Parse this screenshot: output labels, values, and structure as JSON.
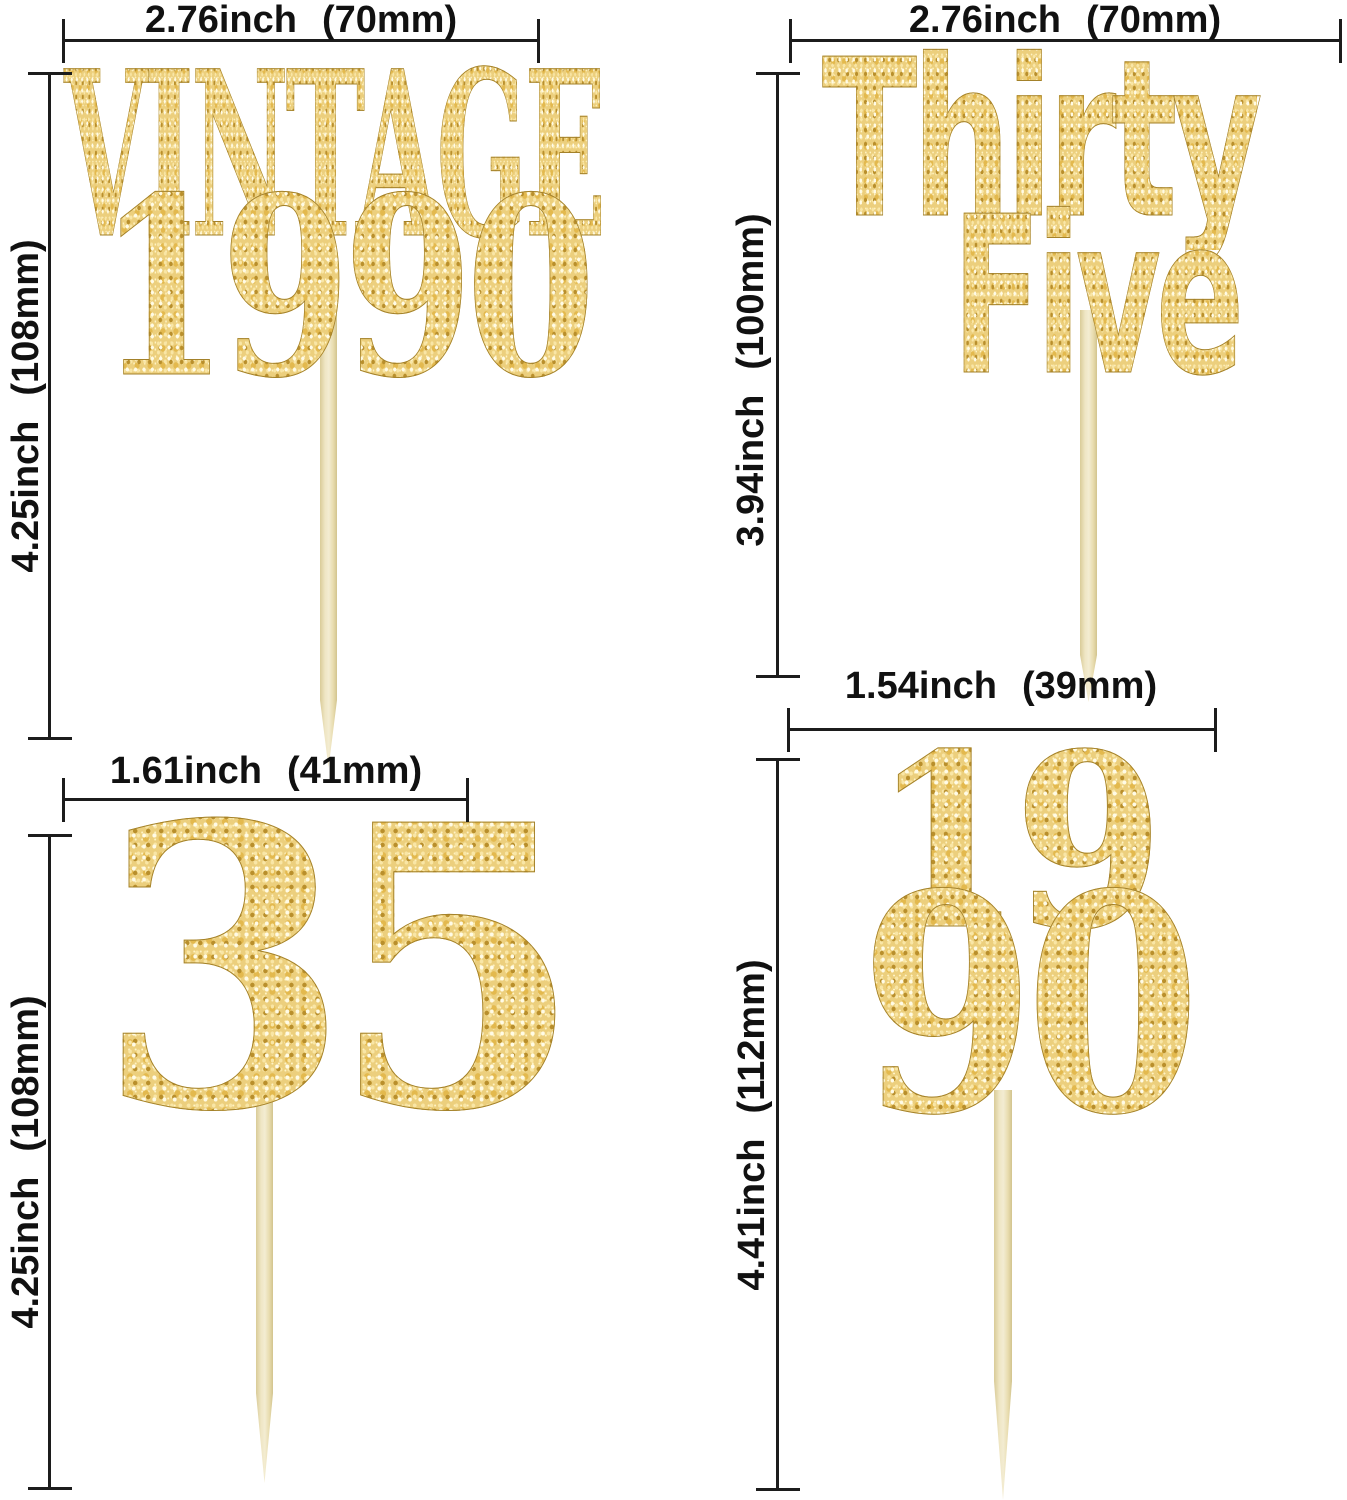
{
  "colors": {
    "background": "#ffffff",
    "dimension_line": "#1c1c1c",
    "label_text": "#111111",
    "gold_base": "#eccf7d",
    "gold_light": "#fffbe6",
    "gold_mid": "#e3b94e",
    "gold_dark": "#b98f2c",
    "gold_edge": "#a3812a",
    "stick_light": "#f3ecd2",
    "stick_dark": "#d9cb98"
  },
  "toppers": [
    {
      "id": "vintage-1990",
      "text_line1": "VINTAGE",
      "text_line2": "1990",
      "width_label": "2.76inch (70mm)",
      "height_label": "4.25inch (108mm)"
    },
    {
      "id": "thirty-five",
      "text_line1": "Thirty",
      "text_line2": "Five",
      "width_label": "2.76inch (70mm)",
      "height_label": "3.94inch (100mm)"
    },
    {
      "id": "number-35",
      "text_line1": "35",
      "width_label": "1.61inch (41mm)",
      "height_label": "4.25inch (108mm)"
    },
    {
      "id": "number-19-90",
      "text_line1": "19",
      "text_line2": "90",
      "width_label": "1.54inch (39mm)",
      "height_label": "4.41inch (112mm)"
    }
  ]
}
